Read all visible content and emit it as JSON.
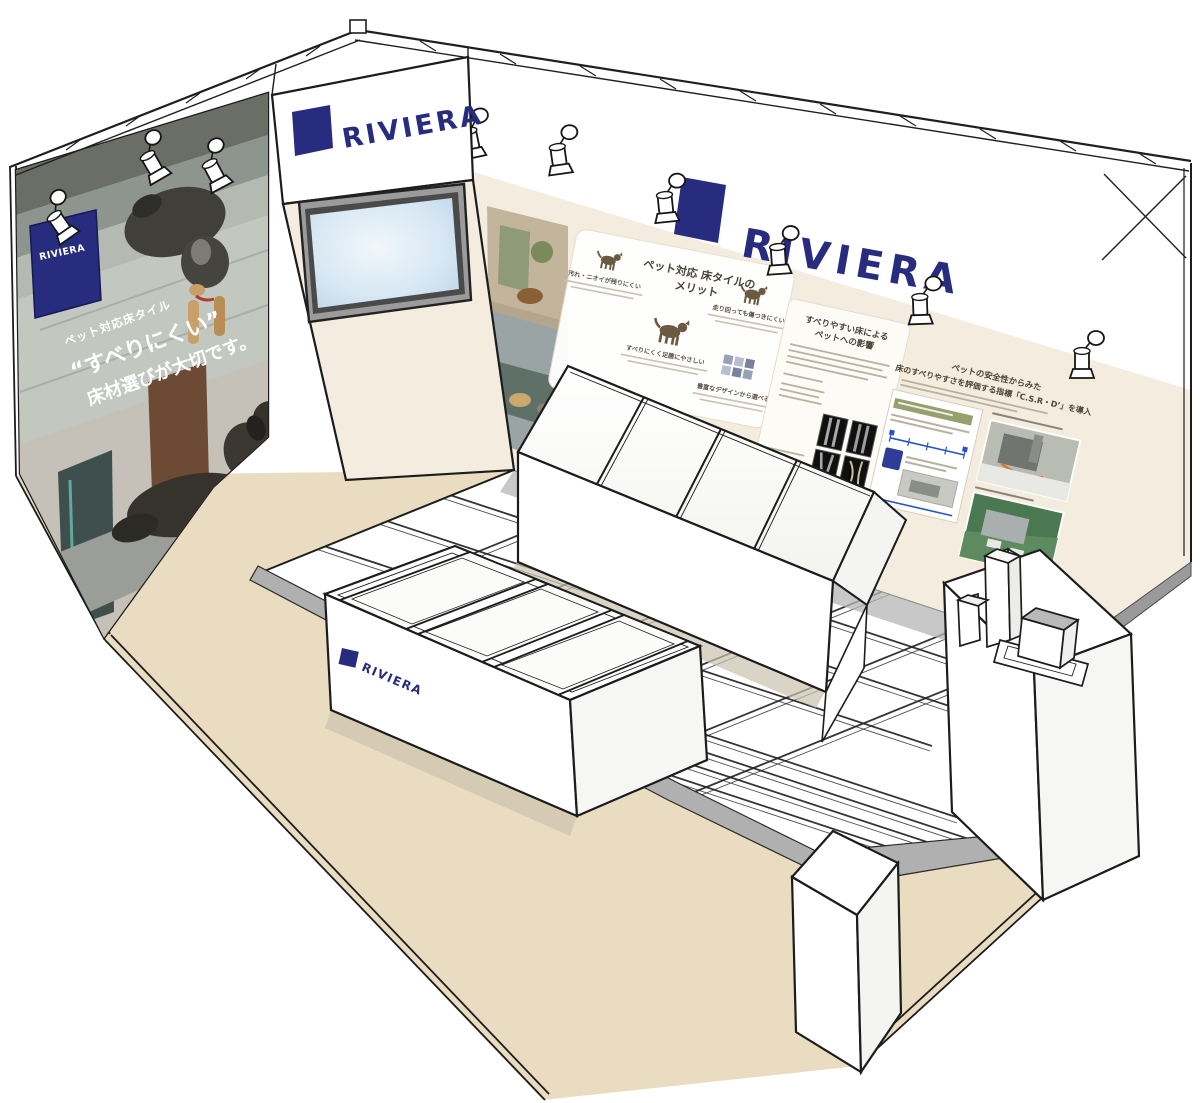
{
  "banner": {
    "logo_text": "RIVIERA"
  },
  "left_wall": {
    "flag_text": "RIVIERA",
    "caption_small": "ペット対応床タイル",
    "caption_line1": "“すべりにくい”",
    "caption_line2": "床材選びが大切です。"
  },
  "back_wall": {
    "logo_text": "RIVIERA"
  },
  "merit_panel": {
    "title_line1": "ペット対応 床タイルの",
    "title_line2": "メリット",
    "items": [
      {
        "label": "汚れ・ニオイが残りにくい"
      },
      {
        "label": "すべりにくく足腰にやさしい"
      },
      {
        "label": "走り回っても傷つきにくい"
      },
      {
        "label": "豊富なデザインから選べる"
      }
    ]
  },
  "impact_panel": {
    "title_line1": "すべりやすい床による",
    "title_line2": "ペットへの影響"
  },
  "csr_panel": {
    "title_line1": "ペットの安全性からみた",
    "title_line2": "床のすべりやすさを評価する指標「C.S.R・D’」を導入"
  },
  "display_table": {
    "logo_text": "RIVIERA"
  },
  "colors": {
    "brand_navy": "#272c7f",
    "wall_cream": "#f4ecdf",
    "carpet_beige": "#e9dcc1",
    "ramp_gray": "#b0b0b0"
  }
}
